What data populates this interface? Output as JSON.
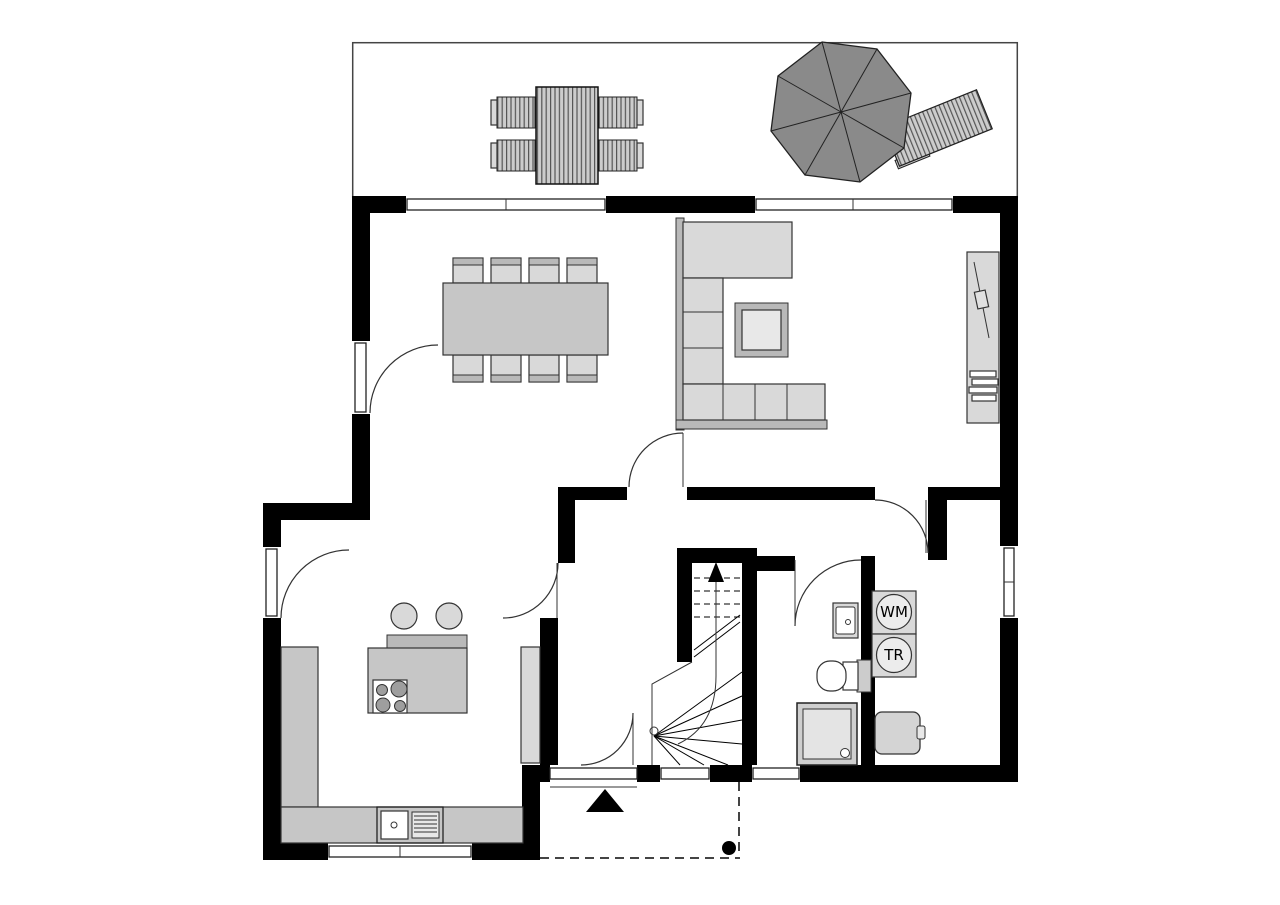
{
  "plan": {
    "kind": "floor-plan",
    "labels": {
      "washing_machine": "WM",
      "dryer": "TR"
    },
    "colors": {
      "wall": "#000000",
      "background": "#ffffff",
      "furniture_light": "#d9d9d9",
      "furniture_mid": "#c6c6c6",
      "furniture_frame": "#b9b9b9",
      "parasol": "#8a8a8a",
      "line": "#222222"
    },
    "icons": [
      "parasol-icon",
      "sun-lounger-icon",
      "outdoor-table-icon",
      "outdoor-chair-icon",
      "dining-table-icon",
      "dining-chair-icon",
      "corner-sofa-icon",
      "coffee-table-icon",
      "tv-sideboard-icon",
      "tv-icon",
      "stereo-icon",
      "kitchen-counter-icon",
      "kitchen-sink-icon",
      "kitchen-island-icon",
      "cooktop-icon",
      "bar-stool-icon",
      "staircase-icon",
      "stair-up-arrow-icon",
      "washbasin-icon",
      "toilet-icon",
      "shower-icon",
      "washing-machine-icon",
      "dryer-icon",
      "boiler-icon",
      "entrance-arrow-icon",
      "porch-post-icon"
    ]
  }
}
